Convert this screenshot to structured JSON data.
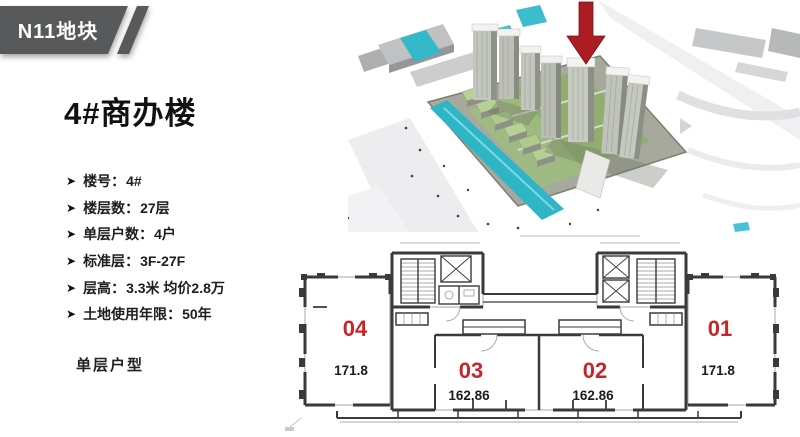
{
  "slide": {
    "background": "#ffffff"
  },
  "badge": {
    "label": "N11地块",
    "background": "#58595b",
    "text_color": "#ffffff"
  },
  "title": {
    "text": "4#商办楼",
    "color": "#111111"
  },
  "specs": {
    "bullet_icon": "➤",
    "colon": "：",
    "items": [
      {
        "label": "楼号",
        "value": "4#"
      },
      {
        "label": "楼层数",
        "value": "27层"
      },
      {
        "label": "单层户数",
        "value": "4户"
      },
      {
        "label": "标准层",
        "value": "3F-27F"
      },
      {
        "label": "层高",
        "value": "3.3米 均价2.8万"
      },
      {
        "label": "土地使用年限",
        "value": "50年"
      }
    ]
  },
  "section_label": "单层户型",
  "floor_plan": {
    "number_color": "#c5262c",
    "area_color": "#1b1b1b",
    "wall_color": "#3a3a3c",
    "units": [
      {
        "number": "04",
        "area": "171.8"
      },
      {
        "number": "03",
        "area": "162.86"
      },
      {
        "number": "02",
        "area": "162.86"
      },
      {
        "number": "01",
        "area": "171.8"
      }
    ]
  },
  "aerial": {
    "arrow_color": "#ab1d22",
    "water_color": "#2fb6c6"
  }
}
